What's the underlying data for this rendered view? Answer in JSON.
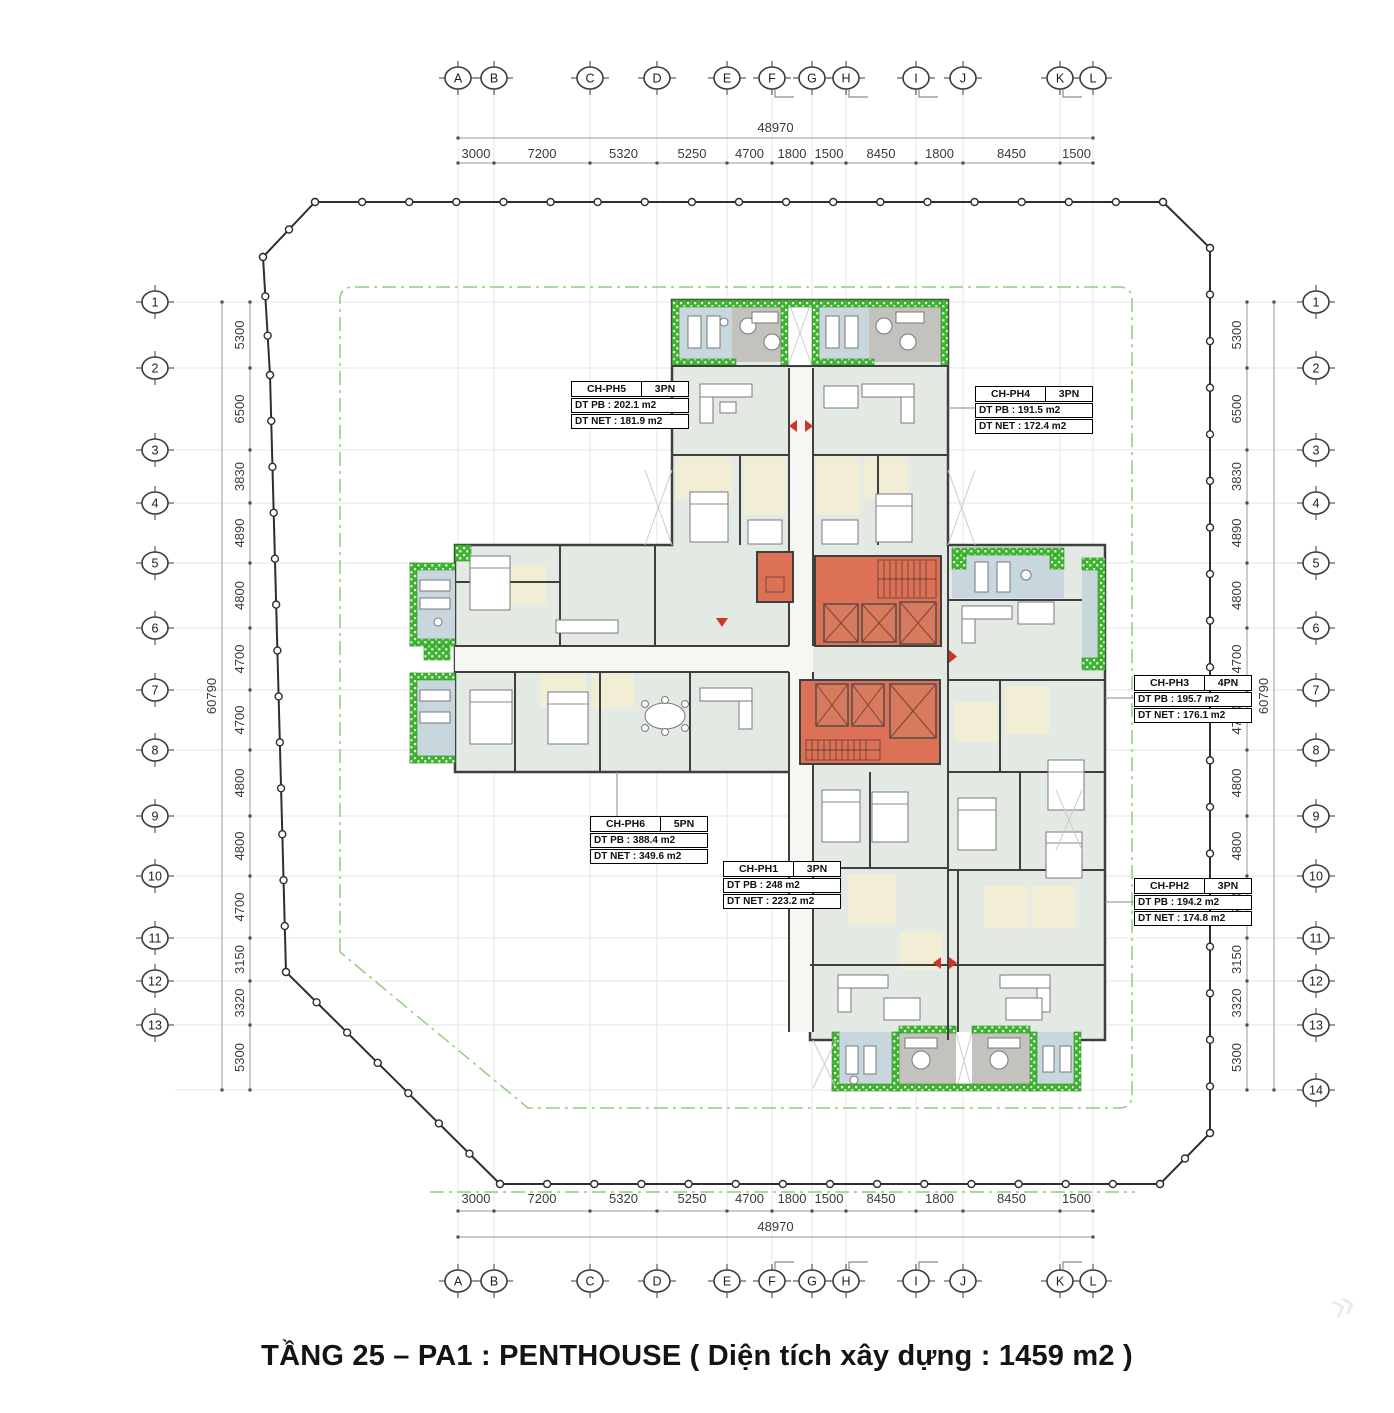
{
  "title": "TẦNG 25 – PA1 : PENTHOUSE ( Diện tích xây dựng : 1459 m2 )",
  "axes": {
    "columns": {
      "labels": [
        "A",
        "B",
        "C",
        "D",
        "E",
        "F",
        "G",
        "H",
        "I",
        "J",
        "K",
        "L"
      ],
      "x": [
        458,
        494,
        590,
        657,
        727,
        772,
        812,
        846,
        916,
        963,
        1060,
        1093
      ],
      "segments": [
        "3000",
        "7200",
        "5320",
        "5250",
        "4700",
        "1800",
        "1500",
        "8450",
        "1800",
        "8450",
        "1500"
      ],
      "total": "48970",
      "flagged": [
        "F",
        "H",
        "I",
        "K"
      ]
    },
    "rows": {
      "labels": [
        "1",
        "2",
        "3",
        "4",
        "5",
        "6",
        "7",
        "8",
        "9",
        "10",
        "11",
        "12",
        "13",
        "14"
      ],
      "y": [
        302,
        368,
        450,
        503,
        563,
        628,
        690,
        750,
        816,
        876,
        938,
        981,
        1025,
        1090
      ],
      "segments": [
        "5300",
        "6500",
        "3830",
        "4890",
        "4800",
        "4700",
        "4700",
        "4800",
        "4800",
        "4700",
        "3150",
        "3320",
        "5300"
      ],
      "total": "60790",
      "left_visible": 13
    }
  },
  "apartments": [
    {
      "code": "CH-PH5",
      "type": "3PN",
      "dt_pb": "DT PB : 202.1 m2",
      "dt_net": "DT NET : 181.9 m2"
    },
    {
      "code": "CH-PH4",
      "type": "3PN",
      "dt_pb": "DT PB : 191.5 m2",
      "dt_net": "DT NET : 172.4 m2"
    },
    {
      "code": "CH-PH3",
      "type": "4PN",
      "dt_pb": "DT PB : 195.7 m2",
      "dt_net": "DT NET : 176.1 m2"
    },
    {
      "code": "CH-PH6",
      "type": "5PN",
      "dt_pb": "DT PB : 388.4 m2",
      "dt_net": "DT NET : 349.6 m2"
    },
    {
      "code": "CH-PH1",
      "type": "3PN",
      "dt_pb": "DT PB : 248 m2",
      "dt_net": "DT NET : 223.2 m2"
    },
    {
      "code": "CH-PH2",
      "type": "3PN",
      "dt_pb": "DT PB : 194.2 m2",
      "dt_net": "DT NET : 174.8 m2"
    }
  ],
  "colors": {
    "core_red": "#dc7156",
    "planter_green": "#3db42f",
    "balcony_blue": "#c8d6dd",
    "terrace_gray": "#c3c2bc",
    "floor": "#e3eae4",
    "bath_cream": "#f2eed6",
    "wall": "#3f3f3f",
    "arrow_red": "#cf3526",
    "boundary": "#2e2e2e",
    "setback_green": "#8fce7f",
    "dim_text": "#3a3a3a"
  }
}
